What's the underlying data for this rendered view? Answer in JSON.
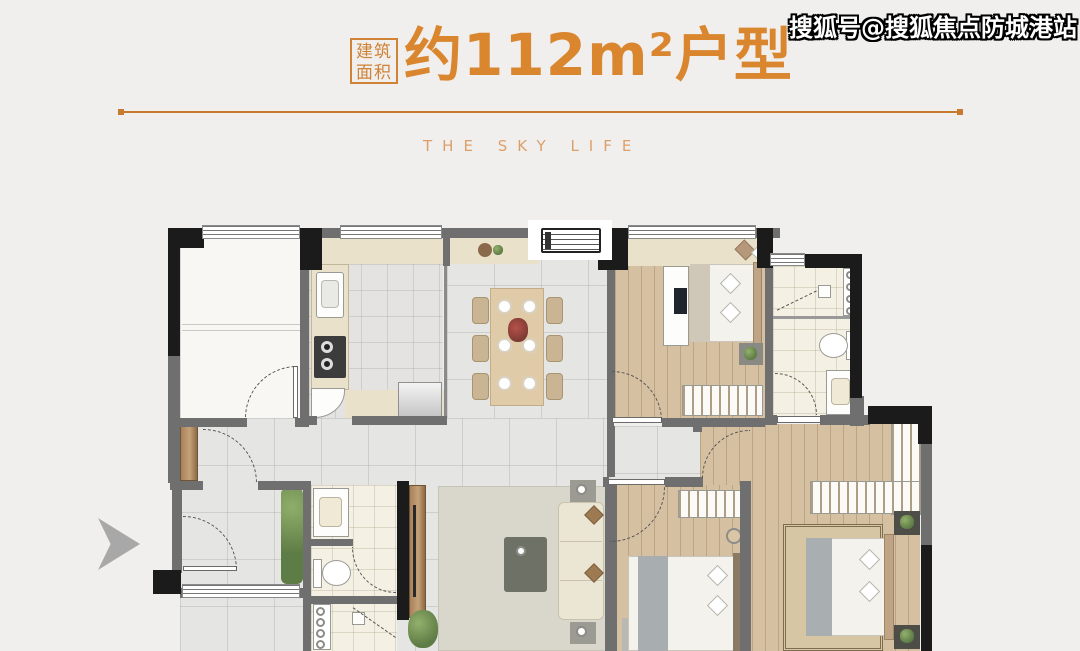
{
  "header": {
    "badge": {
      "line1": "建筑",
      "line2": "面积"
    },
    "title": "约112m²户型",
    "subtitle": "THE SKY LIFE"
  },
  "watermark": {
    "text": "搜狐号@搜狐焦点防城港站"
  },
  "colors": {
    "accent_orange": "#d9862f",
    "divider_line": "#c87a2e",
    "subtitle_orange": "#dd9f68",
    "page_background": "#f0efee",
    "wall_black": "#1b1b1b",
    "wall_gray": "#6f6f6f",
    "wood_floor": "#d5c0a2",
    "marble_floor": "#e5e5e3",
    "counter_beige": "#eae1cb",
    "plant_green": "#5e7c45",
    "watermark_text": "#ffffff"
  }
}
